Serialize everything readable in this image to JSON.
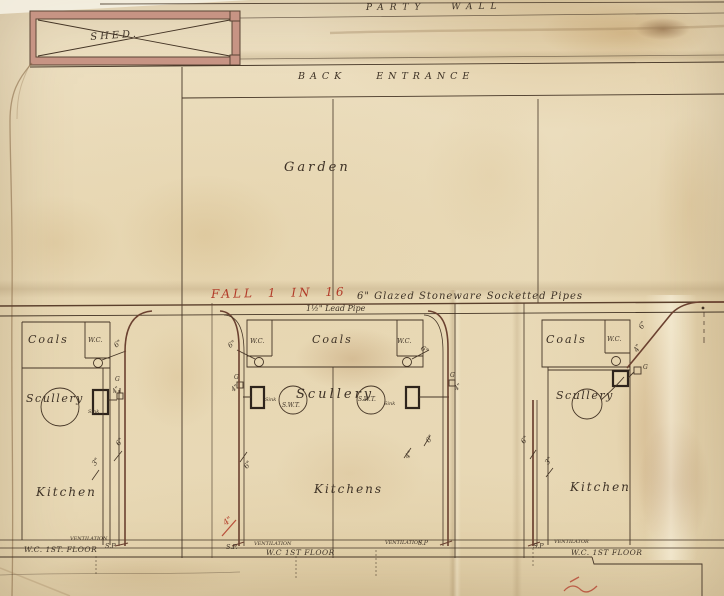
{
  "drawing": {
    "party_wall": "PARTY WALL",
    "shed": "SHED.",
    "back_entrance": "BACK ENTRANCE",
    "garden": "Garden",
    "fall_note": "FALL 1 IN 16",
    "pipe_spec": "6\" Glazed Stoneware   Socketted Pipes",
    "lead_pipe": "1½\" Lead Pipe"
  },
  "rooms": {
    "coals": "Coals",
    "wc": "W.C.",
    "scullery": "Scullery",
    "kitchen": "Kitchen",
    "kitchens": "Kitchens",
    "sink": "Sink",
    "swt": "S.W.T."
  },
  "pipes": {
    "d6": "6\"",
    "d4": "4\"",
    "d3": "3\"",
    "gully": "G",
    "soil_pipe": "S.P",
    "soil_pipe_dot": "S.P.",
    "ventilation": "VENTILATION",
    "ventilator": "VENTILATOR",
    "wc_first_floor_left": "W.C. 1ST. FLOOR",
    "wc_first_floor_mid": "W.C 1ST FLOOR",
    "wc_first_floor_right": "W.C. 1ST FLOOR"
  },
  "colors": {
    "paper": "#e8dabb",
    "ink": "#453526",
    "red": "#b23a28",
    "pipe_brown": "#6b4130",
    "wall_pink": "#c79484"
  }
}
